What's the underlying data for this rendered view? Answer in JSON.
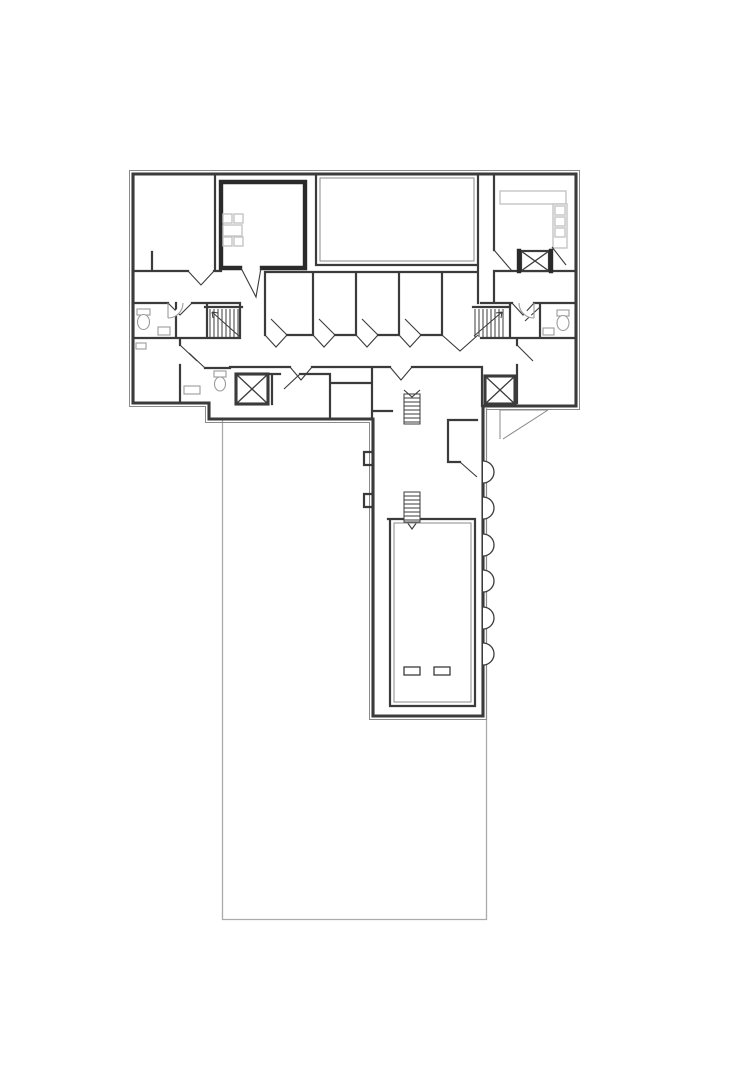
{
  "page": {
    "title": "Architectural floor plan drawing",
    "background": "#ffffff"
  },
  "colors": {
    "wall": "#3b3b3b",
    "wall_dark": "#2a2a2a",
    "thin": "#8a8a8a",
    "furniture": "#c4c4c4",
    "fixture": "#9b9b9b",
    "site": "#ababab"
  },
  "plan": {
    "type": "floor-plan",
    "orientation": "T-shaped building with long south wing",
    "upper_block": {
      "rooms": [
        "room-northwest",
        "room-thick-border-with-table",
        "large-hall-center",
        "kitchen-room-northeast",
        "small-room-row-1",
        "small-room-row-2",
        "small-room-row-3",
        "small-room-row-4",
        "bathroom-northwest",
        "bathroom-southwest",
        "bathroom-northeast",
        "room-southwest",
        "room-southeast"
      ],
      "stairwells": 2,
      "elevator_shafts": 3,
      "corridor": "east-west central corridor"
    },
    "lower_wing": {
      "ladders": 2,
      "attached_half_columns": 6,
      "wall_niches": 2,
      "floor_openings": 2,
      "alcove": 1,
      "chamber": "double-walled hall at south end"
    },
    "furniture": {
      "table_with_chairs": {
        "chairs": 4,
        "location": "room-thick-border-with-table"
      },
      "kitchen_counter_units": 3
    },
    "site": {
      "outline": "light gray rectangular site boundary extending south"
    }
  }
}
